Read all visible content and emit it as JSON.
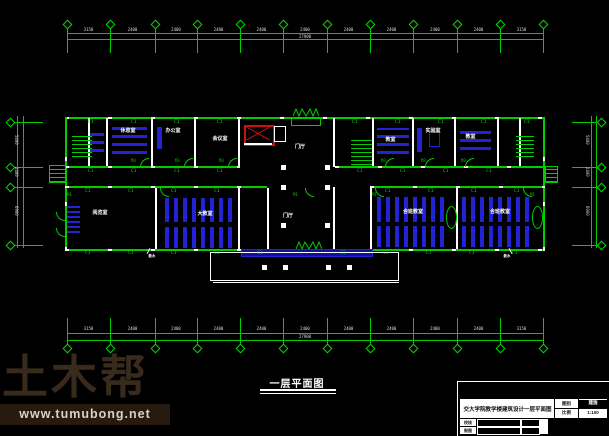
{
  "canvas": {
    "background": "#000000"
  },
  "colors": {
    "line_green": "#00cc00",
    "furniture_blue": "#2323d6",
    "elevator_red": "#cc1111",
    "wall_white": "#ffffff",
    "watermark_brown": "#392b1b"
  },
  "dims": {
    "top": {
      "total": "27900",
      "bays": [
        "3150",
        "2400",
        "2400",
        "2400",
        "2400",
        "2400",
        "2400",
        "2400",
        "2400",
        "2400",
        "3150"
      ]
    },
    "bottom": {
      "total": "27900",
      "bays": [
        "3150",
        "2400",
        "2400",
        "2400",
        "2400",
        "2400",
        "2400",
        "2400",
        "2400",
        "2400",
        "3150"
      ]
    },
    "left": {
      "bays": [
        "5400",
        "2400",
        "6900"
      ]
    },
    "right": {
      "bays": [
        "5400",
        "2400",
        "6900"
      ]
    }
  },
  "labels": {
    "window": "C1",
    "door_main": "M1",
    "door_room": "M3",
    "hall": "门厅",
    "note": "散水"
  },
  "rooms": {
    "top": [
      "休息室",
      "办公室",
      "会议室",
      "教室",
      "实验室",
      "教室"
    ],
    "bottom": [
      "阅览室",
      "大教室",
      "合班教室",
      "合班教室"
    ]
  },
  "drawing_title": "一层平面图",
  "title_block": {
    "project": "交大学院教学楼建筑设计一层平面图",
    "sheet_type_label": "图别",
    "sheet_type": "建施",
    "scale_label": "比例",
    "scale": "1:100",
    "row_labels": [
      "校核",
      "制图"
    ]
  },
  "watermark": {
    "brand": "土木帮",
    "url": "www.tumubong.net"
  }
}
